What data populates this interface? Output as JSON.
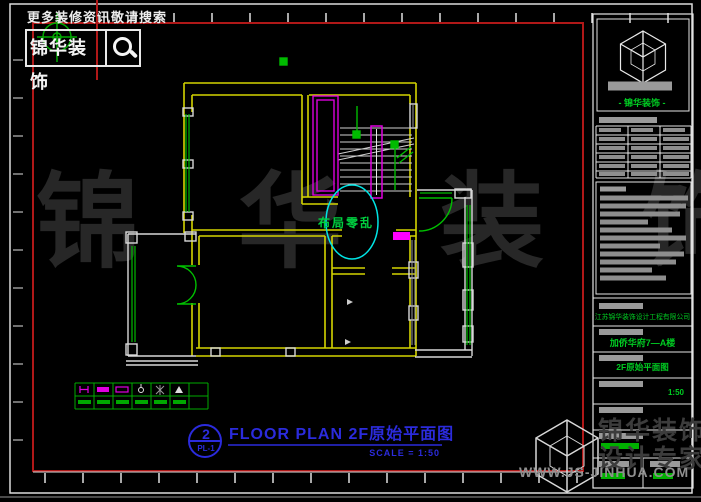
{
  "header": {
    "search_hint": "更多装修资讯敬请搜索",
    "brand": "锦华装饰"
  },
  "drawing": {
    "annotation": "布局零乱",
    "title_no": "2",
    "title_ref": "PL-1",
    "title": "FLOOR PLAN 2F原始平面图",
    "scale": "SCALE = 1:50"
  },
  "title_block": {
    "brand": "- 锦华装饰 -",
    "company": "江苏锦华装饰设计工程有限公司",
    "project": "加侨华府7—A楼",
    "drawing_name": "2F原始平面图",
    "scale": "1:50"
  },
  "watermark": {
    "center": "锦 华 装 饰",
    "brand_line1": "锦华装饰",
    "brand_line2": "设计专家",
    "url": "WWW.JS-JINHUA.COM"
  },
  "legend": {
    "symbols": [
      "switch-symbol",
      "light-strip-symbol",
      "outlet-box-symbol",
      "pendant-lamp-symbol",
      "ceiling-fixture-symbol",
      "valve-flag-symbol"
    ]
  },
  "colors": {
    "wall_yellow": "#d4d400",
    "window_green": "#00cc00",
    "fixture_magenta": "#e000e0",
    "annotation_cyan": "#00e5e5",
    "frame_red": "#b01818",
    "title_blue": "#2b2bdc"
  }
}
